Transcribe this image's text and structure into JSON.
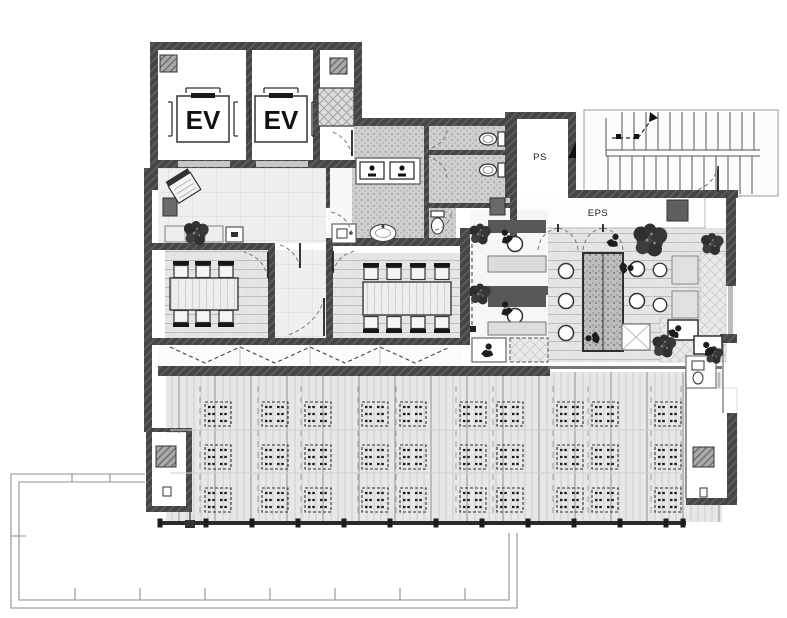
{
  "floor_plan": {
    "labels": {
      "elevator_1": "EV",
      "elevator_2": "EV",
      "pipe_shaft": "PS",
      "electrical_pipe_shaft": "EPS"
    },
    "palette": {
      "wall": "#454545",
      "column_hatch": "#aaaaaa",
      "restroom_floor": "#cfcfcf",
      "tile_floor": "#f0f0f0",
      "plank_floor": "#e6e6e6",
      "booth_dark": "#575757",
      "window_band": "#2b2b2b",
      "terrace_line": "#8f8f8f"
    }
  }
}
